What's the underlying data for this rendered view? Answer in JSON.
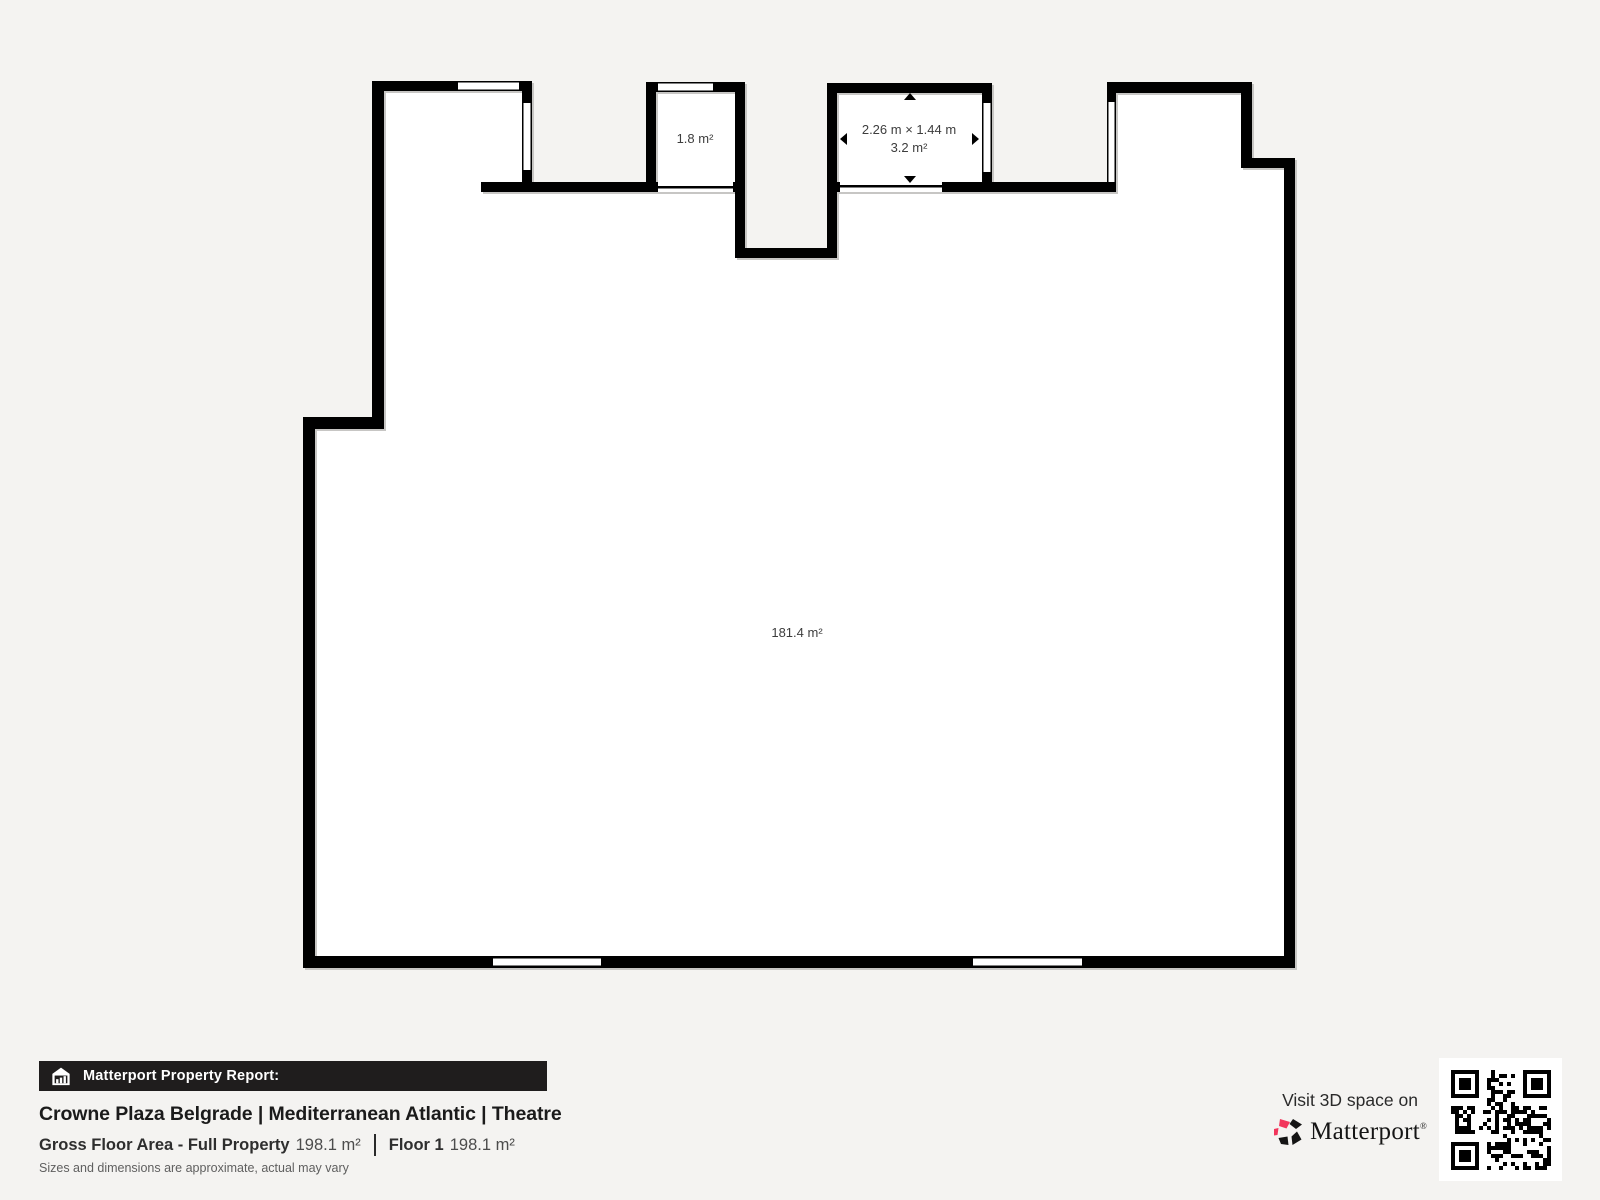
{
  "floor_plan": {
    "main_room_area": "181.4 m²",
    "closet_area": "1.8 m²",
    "storage_dimensions": "2.26 m × 1.44 m",
    "storage_area": "3.2 m²"
  },
  "report": {
    "banner_label": "Matterport Property Report:",
    "title": "Crowne Plaza Belgrade | Mediterranean Atlantic | Theatre",
    "gross_floor_area_label": "Gross Floor Area - Full Property",
    "gross_floor_area_value": "198.1 m²",
    "floor_label": "Floor 1",
    "floor_value": "198.1 m²",
    "disclaimer": "Sizes and dimensions are approximate, actual may vary"
  },
  "promo": {
    "visit_label": "Visit 3D space on",
    "brand_name": "Matterport",
    "trademark": "®"
  },
  "colors": {
    "background": "#f4f3f1",
    "wall": "#000000",
    "floor": "#ffffff",
    "banner_bg": "#1f1d1d",
    "accent_red": "#f2355b",
    "label_text": "#3d3d3d"
  }
}
